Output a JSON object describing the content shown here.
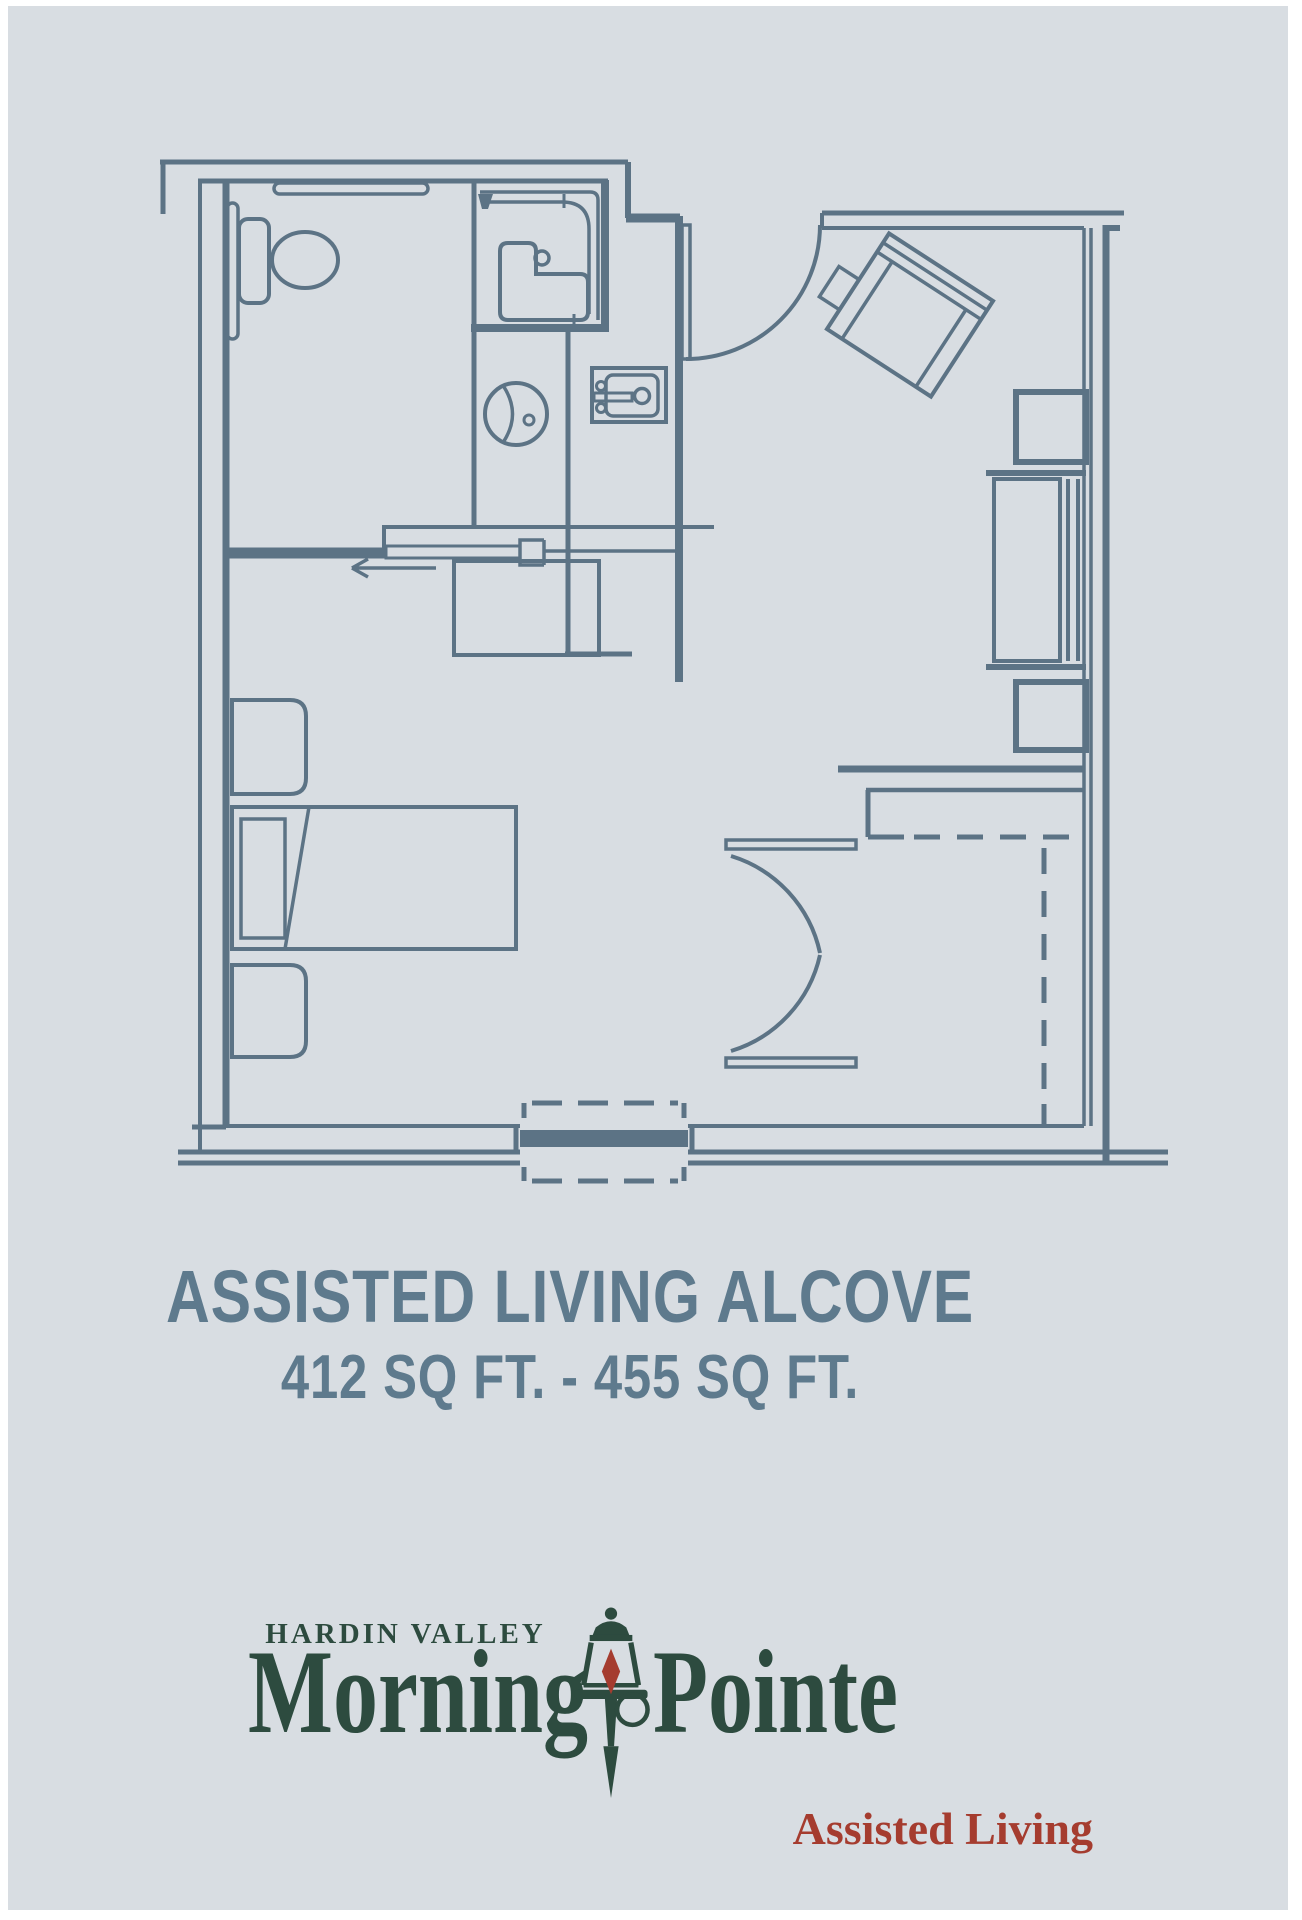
{
  "colors": {
    "canvas": "#ffffff",
    "background": "#d8dde2",
    "plan_line": "#5c7385",
    "title_text": "#5e7a8d",
    "logo_green": "#2d4b3f",
    "logo_red": "#a53c2f"
  },
  "plan": {
    "label": "Assisted Living Alcove unit floor plan",
    "fixtures": [
      "toilet",
      "grab-bars",
      "shower",
      "shower-seat",
      "vanity-sink",
      "kitchenette-sink",
      "pocket-door",
      "entry-door",
      "desk",
      "nightstand",
      "bed",
      "armchair",
      "side-table",
      "dresser",
      "double-doors",
      "alcove",
      "window"
    ]
  },
  "title": "ASSISTED LIVING ALCOVE",
  "square_footage": "412 SQ FT. - 455 SQ FT.",
  "logo": {
    "location": "HARDIN VALLEY",
    "brand_left": "Morning",
    "brand_right": "Pointe",
    "tagline": "Assisted Living"
  }
}
